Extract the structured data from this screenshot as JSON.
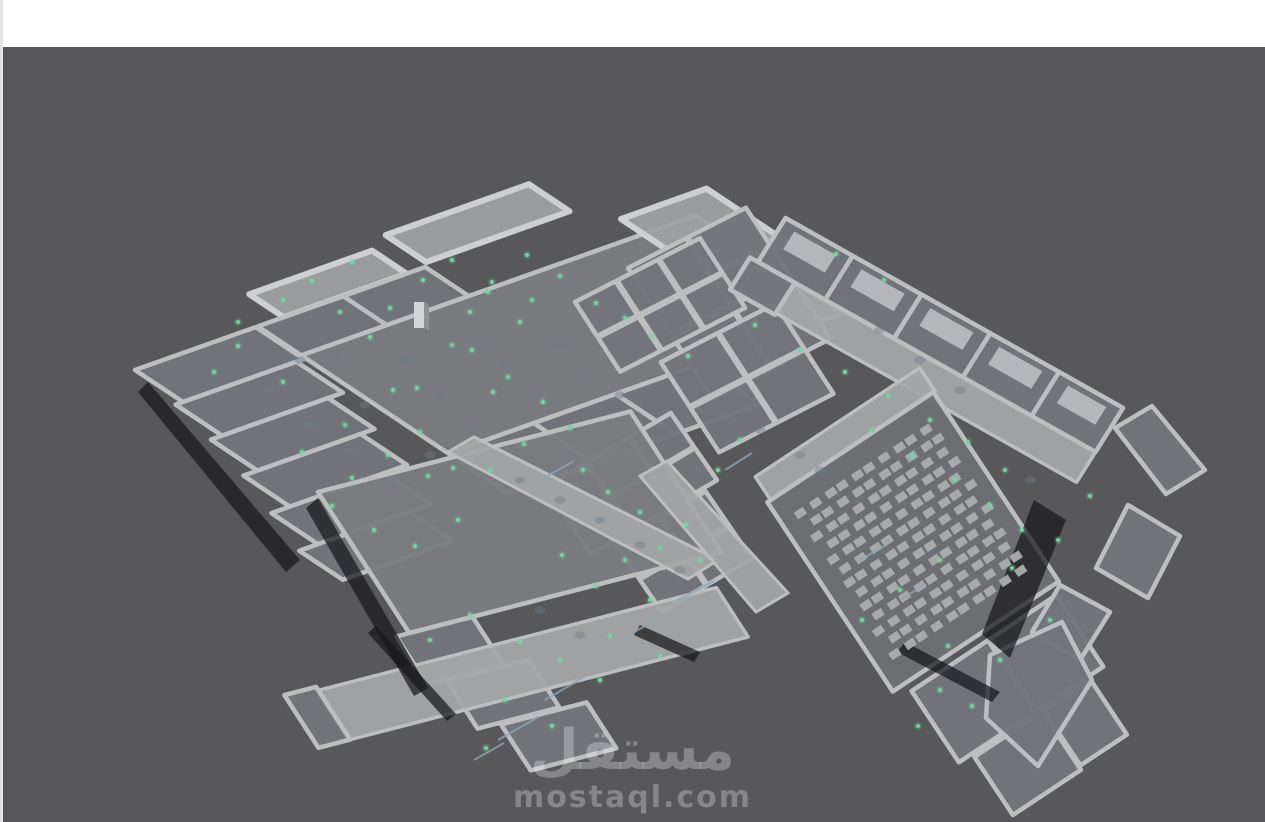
{
  "scene": {
    "description": "Isometric 3D building floor-plan model in grey viewport",
    "sensor_count": 92
  },
  "watermark": {
    "title": "مستقل",
    "domain": "mostaql.com"
  },
  "colors": {
    "page": "#ffffff",
    "edge_strip": "#e4e4e4",
    "viewport_bg": "#58585a",
    "wall": "#bcbec0",
    "wall_hi": "#cdcfd1",
    "floor": "#73757a",
    "floor_hall": "#7a7c7f",
    "floor_dark": "#6c6e72",
    "corridor": "#a4a5a7",
    "window_patch": "#c2c3c5",
    "shadow": "#17171a",
    "dot": "#70d8a1",
    "fixture": "#6e7b86",
    "furniture": "#abacae",
    "door_mark": "#8ea5b4",
    "pillar_light": "#d4d5d6",
    "pillar_dark": "#8f9193",
    "watermark_text": "rgba(255,255,255,0.28)"
  },
  "sensors": {
    "points": [
      [
        352,
        262
      ],
      [
        312,
        281
      ],
      [
        283,
        300
      ],
      [
        238,
        322
      ],
      [
        214,
        372
      ],
      [
        238,
        346
      ],
      [
        452,
        260
      ],
      [
        492,
        282
      ],
      [
        527,
        255
      ],
      [
        560,
        276
      ],
      [
        532,
        300
      ],
      [
        390,
        308
      ],
      [
        423,
        280
      ],
      [
        488,
        292
      ],
      [
        340,
        312
      ],
      [
        370,
        337
      ],
      [
        472,
        350
      ],
      [
        508,
        377
      ],
      [
        543,
        402
      ],
      [
        345,
        425
      ],
      [
        393,
        390
      ],
      [
        420,
        432
      ],
      [
        452,
        345
      ],
      [
        470,
        312
      ],
      [
        493,
        392
      ],
      [
        520,
        322
      ],
      [
        388,
        455
      ],
      [
        428,
        476
      ],
      [
        352,
        478
      ],
      [
        302,
        452
      ],
      [
        332,
        506
      ],
      [
        374,
        530
      ],
      [
        415,
        546
      ],
      [
        458,
        520
      ],
      [
        490,
        470
      ],
      [
        524,
        444
      ],
      [
        283,
        382
      ],
      [
        417,
        388
      ],
      [
        570,
        428
      ],
      [
        453,
        468
      ],
      [
        596,
        303
      ],
      [
        625,
        318
      ],
      [
        652,
        336
      ],
      [
        688,
        356
      ],
      [
        583,
        470
      ],
      [
        608,
        492
      ],
      [
        640,
        512
      ],
      [
        660,
        548
      ],
      [
        700,
        560
      ],
      [
        686,
        525
      ],
      [
        625,
        560
      ],
      [
        596,
        586
      ],
      [
        650,
        600
      ],
      [
        562,
        555
      ],
      [
        718,
        470
      ],
      [
        740,
        440
      ],
      [
        755,
        325
      ],
      [
        800,
        350
      ],
      [
        845,
        372
      ],
      [
        888,
        396
      ],
      [
        930,
        420
      ],
      [
        968,
        442
      ],
      [
        836,
        254
      ],
      [
        884,
        280
      ],
      [
        1005,
        470
      ],
      [
        872,
        430
      ],
      [
        912,
        456
      ],
      [
        955,
        480
      ],
      [
        990,
        505
      ],
      [
        1022,
        530
      ],
      [
        940,
        560
      ],
      [
        900,
        590
      ],
      [
        862,
        620
      ],
      [
        948,
        646
      ],
      [
        1012,
        568
      ],
      [
        1058,
        540
      ],
      [
        1090,
        496
      ],
      [
        430,
        640
      ],
      [
        470,
        615
      ],
      [
        520,
        642
      ],
      [
        560,
        660
      ],
      [
        610,
        636
      ],
      [
        505,
        700
      ],
      [
        552,
        726
      ],
      [
        486,
        748
      ],
      [
        600,
        680
      ],
      [
        660,
        656
      ],
      [
        940,
        690
      ],
      [
        972,
        706
      ],
      [
        1000,
        660
      ],
      [
        1050,
        620
      ],
      [
        918,
        726
      ]
    ]
  },
  "fixtures": {
    "points": [
      [
        365,
        405
      ],
      [
        405,
        360
      ],
      [
        440,
        395
      ],
      [
        480,
        340
      ],
      [
        505,
        365
      ],
      [
        535,
        395
      ],
      [
        470,
        430
      ],
      [
        430,
        455
      ],
      [
        390,
        480
      ],
      [
        350,
        450
      ],
      [
        310,
        425
      ],
      [
        560,
        345
      ],
      [
        590,
        370
      ],
      [
        620,
        395
      ],
      [
        300,
        360
      ],
      [
        270,
        390
      ],
      [
        335,
        355
      ],
      [
        520,
        480
      ],
      [
        560,
        500
      ],
      [
        600,
        520
      ],
      [
        640,
        545
      ],
      [
        680,
        570
      ],
      [
        820,
        470
      ],
      [
        860,
        500
      ],
      [
        900,
        530
      ],
      [
        940,
        555
      ],
      [
        980,
        580
      ],
      [
        760,
        430
      ],
      [
        800,
        455
      ],
      [
        840,
        300
      ],
      [
        880,
        330
      ],
      [
        920,
        360
      ],
      [
        960,
        390
      ],
      [
        1030,
        480
      ],
      [
        540,
        610
      ],
      [
        580,
        635
      ]
    ]
  },
  "door_marks": [
    [
      545,
      700,
      584,
      677
    ],
    [
      498,
      740,
      538,
      717
    ],
    [
      474,
      760,
      504,
      743
    ],
    [
      620,
      640,
      656,
      620
    ],
    [
      678,
      600,
      714,
      581
    ],
    [
      725,
      470,
      752,
      453
    ],
    [
      540,
      480,
      574,
      461
    ],
    [
      860,
      560,
      886,
      545
    ],
    [
      900,
      600,
      926,
      584
    ]
  ],
  "furniture_grid": {
    "rows": 13,
    "cols": 10,
    "origin": [
      802,
      512
    ],
    "u": [
      0.83,
      -0.55
    ],
    "v": [
      0.55,
      0.83
    ],
    "du": 16.5,
    "dv": 14.2,
    "size": [
      11,
      8
    ]
  }
}
